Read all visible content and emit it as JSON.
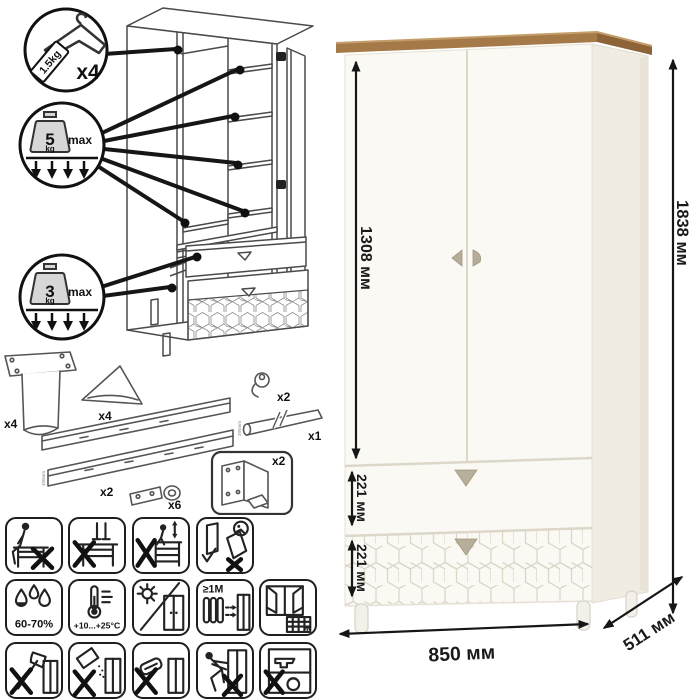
{
  "badges": {
    "hanger": {
      "tag": "1.5kg",
      "count": "x4"
    },
    "shelf_load": {
      "value": "5",
      "unit": "kg",
      "limit": "max"
    },
    "drawer_load": {
      "value": "3",
      "unit": "kg",
      "limit": "max"
    }
  },
  "hardware": {
    "leg_count": "x4",
    "corner_cover_count": "x4",
    "rod_holder_count": "x2",
    "rod_count": "x1",
    "rod_length": "395mm",
    "slide_count": "x2",
    "slide_length": "450mm",
    "hinge_count": "x6",
    "corner_bracket_count": "x2"
  },
  "care": {
    "humidity": "60-70%",
    "temperature": "+10...+25°C",
    "min_distance": "≥1M",
    "calendar_day": "21",
    "icons": [
      "no-sitting",
      "no-standing",
      "no-climbing",
      "carry-doors-upright",
      "humidity-range",
      "temperature-range",
      "no-direct-sunlight",
      "keep-1m-from-heaters",
      "ventilate-room",
      "no-sharp-tools",
      "no-abrasives",
      "no-solvents",
      "do-not-drag",
      "no-heavy-objects"
    ]
  },
  "dimensions": {
    "door_height": "1308 мм",
    "total_height": "1838 мм",
    "top_drawer_height": "221 мм",
    "bottom_drawer_height": "221 мм",
    "width": "850 мм",
    "depth": "511 мм"
  },
  "colors": {
    "top_trim": "#a67a48",
    "body": "#fbf9f4",
    "side": "#f0ece1",
    "handle": "#b5ac9a"
  }
}
